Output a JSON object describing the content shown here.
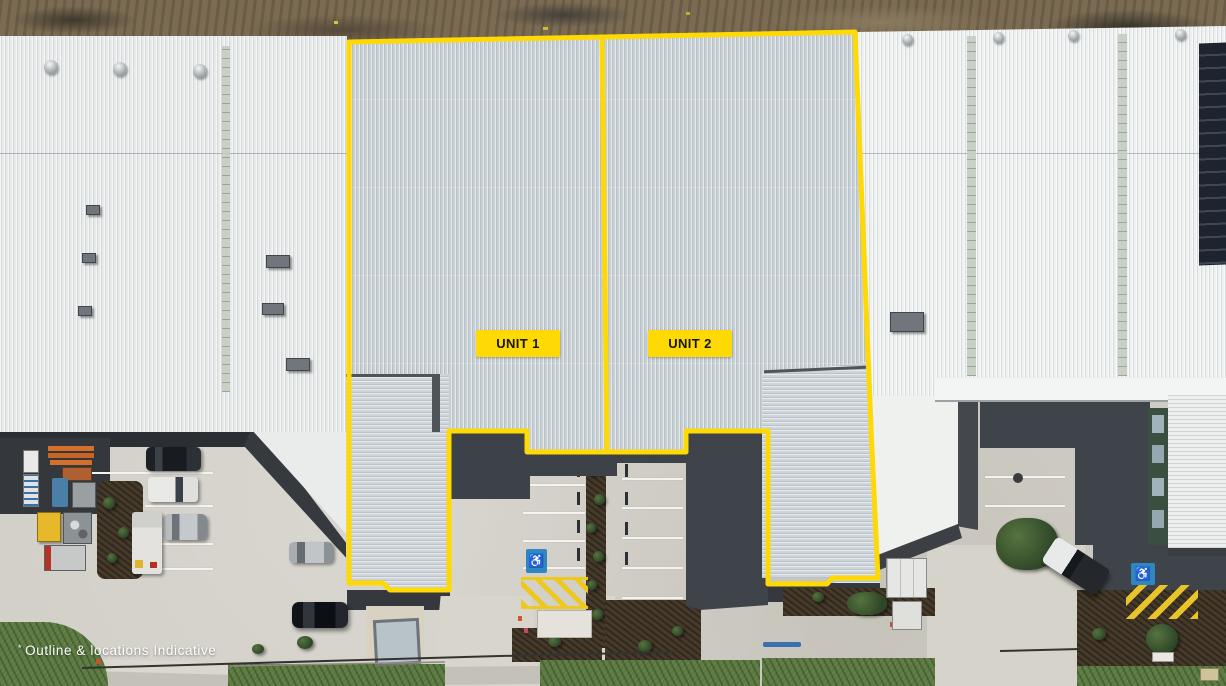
{
  "image": {
    "type": "aerial-drone-photo",
    "subject": "Industrial warehouse estate with two marketed units outlined",
    "disclaimer_mark": "*",
    "disclaimer": "Outline & locations Indicative"
  },
  "annotations": {
    "units": [
      {
        "label": "UNIT 1"
      },
      {
        "label": "UNIT 2"
      }
    ],
    "outline_color": "#FFD903",
    "label_bg": "#FFD903",
    "label_text_color": "#161616",
    "disclaimer_color": "#FFFFFF"
  },
  "markings": {
    "disabled_bay_icon": "♿",
    "disabled_bay_color": "#2F86C0",
    "hatch_zone_color": "#EEC81F",
    "parking_line_color": "#F4F3EE"
  },
  "palette": {
    "dirt": "#7B6B52",
    "roof_main": "#C8CFD5",
    "roof_left": "#E8EBEA",
    "roof_right": "#EEF1F0",
    "awning": "#CED4D9",
    "shadow_asphalt": "#3F434A",
    "concrete": "#D1CEC6",
    "grass": "#5C7A41",
    "mulch": "#463A2A",
    "solar_panel": "#1D2430"
  }
}
